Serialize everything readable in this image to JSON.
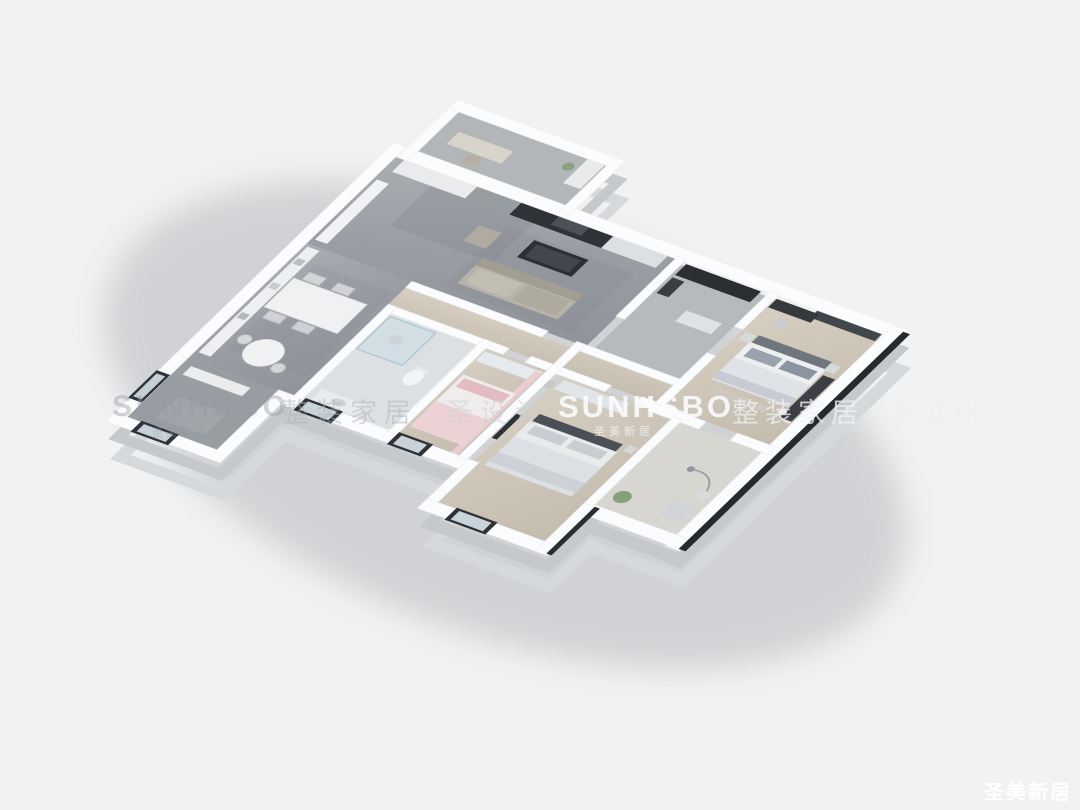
{
  "watermarks": {
    "left_logo": "SUNHSBO",
    "left_logo_sub": "圣美新居",
    "cn_a": "整装家居",
    "cn_b": "圣设计",
    "center_logo": "SUNHSBO",
    "center_logo_sub": "圣美新居",
    "cn_c": "整装家居",
    "cn_d": "圣设计",
    "corner": "圣美新居"
  },
  "colors": {
    "background": "#f1f2f3",
    "wall_top": "#fbfcfd",
    "wall_side": "#c5c9cc",
    "wall_side_outer": "#d5d9dc",
    "wall_dark_edge": "#26292d",
    "floor_marble": "#a0a4a9",
    "floor_wood": "#cfc8bb",
    "floor_tile": "#dde0e3",
    "shadow": "#878b91"
  }
}
